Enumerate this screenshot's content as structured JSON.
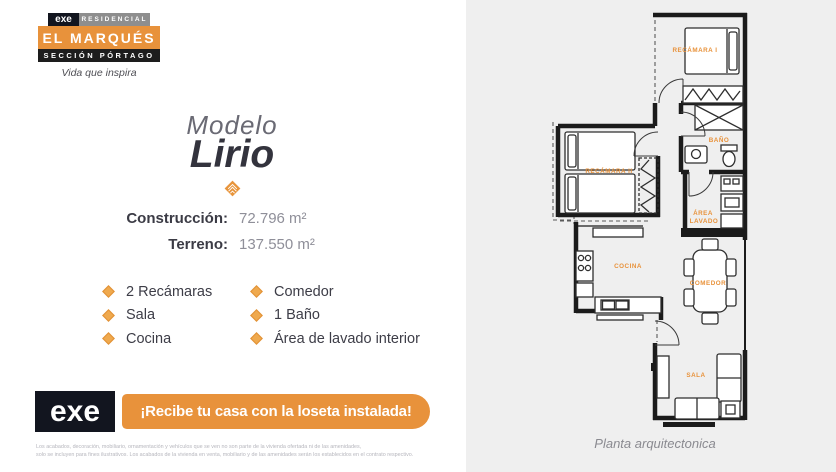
{
  "brand": {
    "logo": "exe",
    "residencial": "RESIDENCIAL",
    "name": "EL MARQUÉS",
    "section": "SECCIÓN PÓRTAGO",
    "tagline": "Vida que inspira"
  },
  "model": {
    "label": "Modelo",
    "name": "Lirio"
  },
  "specs": {
    "construction_label": "Construcción:",
    "construction_value": "72.796 m²",
    "land_label": "Terreno:",
    "land_value": "137.550 m²"
  },
  "features": {
    "col1": [
      "2 Recámaras",
      "Sala",
      "Cocina"
    ],
    "col2": [
      "Comedor",
      "1 Baño",
      "Área de lavado interior"
    ]
  },
  "banner": {
    "logo": "exe",
    "text": "¡Recibe tu casa con la loseta instalada!"
  },
  "disclaimer": {
    "line1": "Los acabados, decoración, mobiliario, ornamentación y vehículos que se ven no son parte de la vivienda ofertada ni de las amenidades,",
    "line2": "solo se incluyen para fines ilustrativos. Los acabados de la vivienda en venta, mobiliario y de las amenidades serán los establecidos en el contrato respectivo."
  },
  "floorplan": {
    "caption": "Planta arquitectonica",
    "labels": {
      "recamara1": "RECÁMARA I",
      "bano": "BAÑO",
      "recamara2": "RECÁMARA II",
      "area": "ÁREA",
      "lavado": "LAVADO",
      "cocina": "COCINA",
      "comedor": "COMEDOR",
      "sala": "SALA"
    }
  },
  "colors": {
    "orange": "#E8923B",
    "dark_navy": "#12151F",
    "gray_band": "#8E8E8E",
    "panel_gray": "#EFEFEF",
    "text_dark": "#3B3B45",
    "text_gray": "#8F8F99"
  }
}
